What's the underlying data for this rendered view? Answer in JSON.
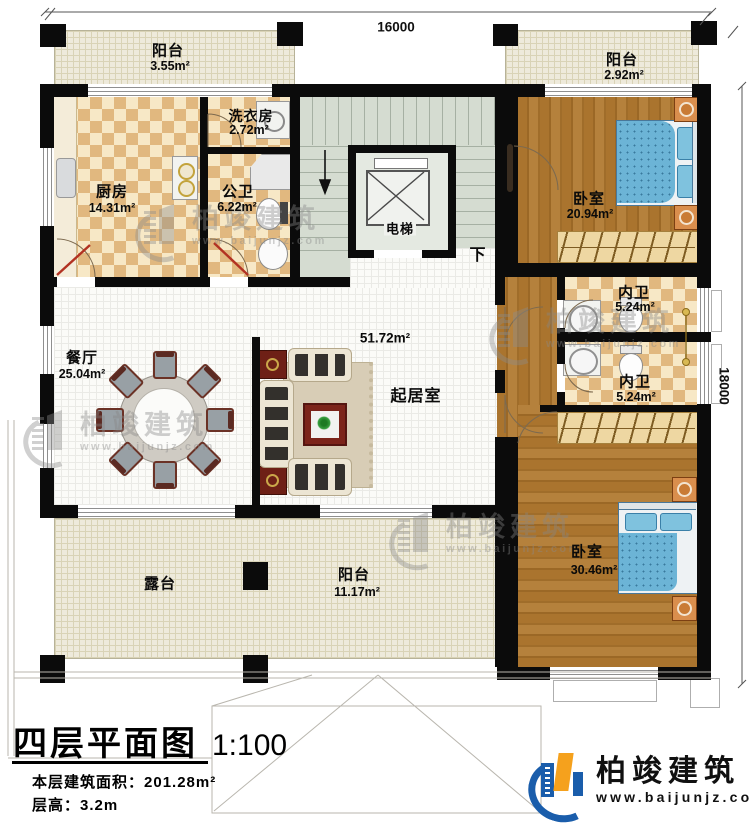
{
  "plan": {
    "dim_top": "16000",
    "dim_right": "18000",
    "stair_down": "下",
    "rooms": {
      "balcony_tl": {
        "label": "阳台",
        "area": "3.55m²"
      },
      "balcony_tr": {
        "label": "阳台",
        "area": "2.92m²"
      },
      "kitchen": {
        "label": "厨房",
        "area": "14.31m²"
      },
      "laundry": {
        "label": "洗衣房",
        "area": "2.72m²"
      },
      "public_bath": {
        "label": "公卫",
        "area": "6.22m²"
      },
      "elevator": {
        "label": "电梯"
      },
      "bedroom_top": {
        "label": "卧室",
        "area": "20.94m²"
      },
      "ensuite_1": {
        "label": "内卫",
        "area": "5.24m²"
      },
      "ensuite_2": {
        "label": "内卫",
        "area": "5.24m²"
      },
      "dining": {
        "label": "餐厅",
        "area": "25.04m²"
      },
      "living": {
        "label": "起居室",
        "area": "51.72m²"
      },
      "bedroom_bottom": {
        "label": "卧室",
        "area": "30.46m²"
      },
      "balcony_bottom": {
        "label": "阳台",
        "area": "11.17m²"
      },
      "terrace": {
        "label": "露台"
      }
    }
  },
  "title_block": {
    "title": "四层平面图",
    "scale": "1:100",
    "area_label": "本层建筑面积：",
    "area_value": "201.28m²",
    "floor_height_label": "层高：",
    "floor_height_value": "3.2m"
  },
  "brand": {
    "name": "柏竣建筑",
    "url": "www.baijunjz.com"
  },
  "watermark": {
    "name": "柏竣建筑",
    "url": "www.baijunjz.com"
  },
  "colors": {
    "wall": "#0b0b0b",
    "wood_floor": "#aa742e",
    "checker_tile": "#e1b87f",
    "outdoor_hatch": "#eeeadb",
    "stair": "#d5dcd1",
    "bed_blue": "#6cb4d6",
    "brand_blue": "#1a5dab",
    "brand_orange": "#f5a11d"
  }
}
